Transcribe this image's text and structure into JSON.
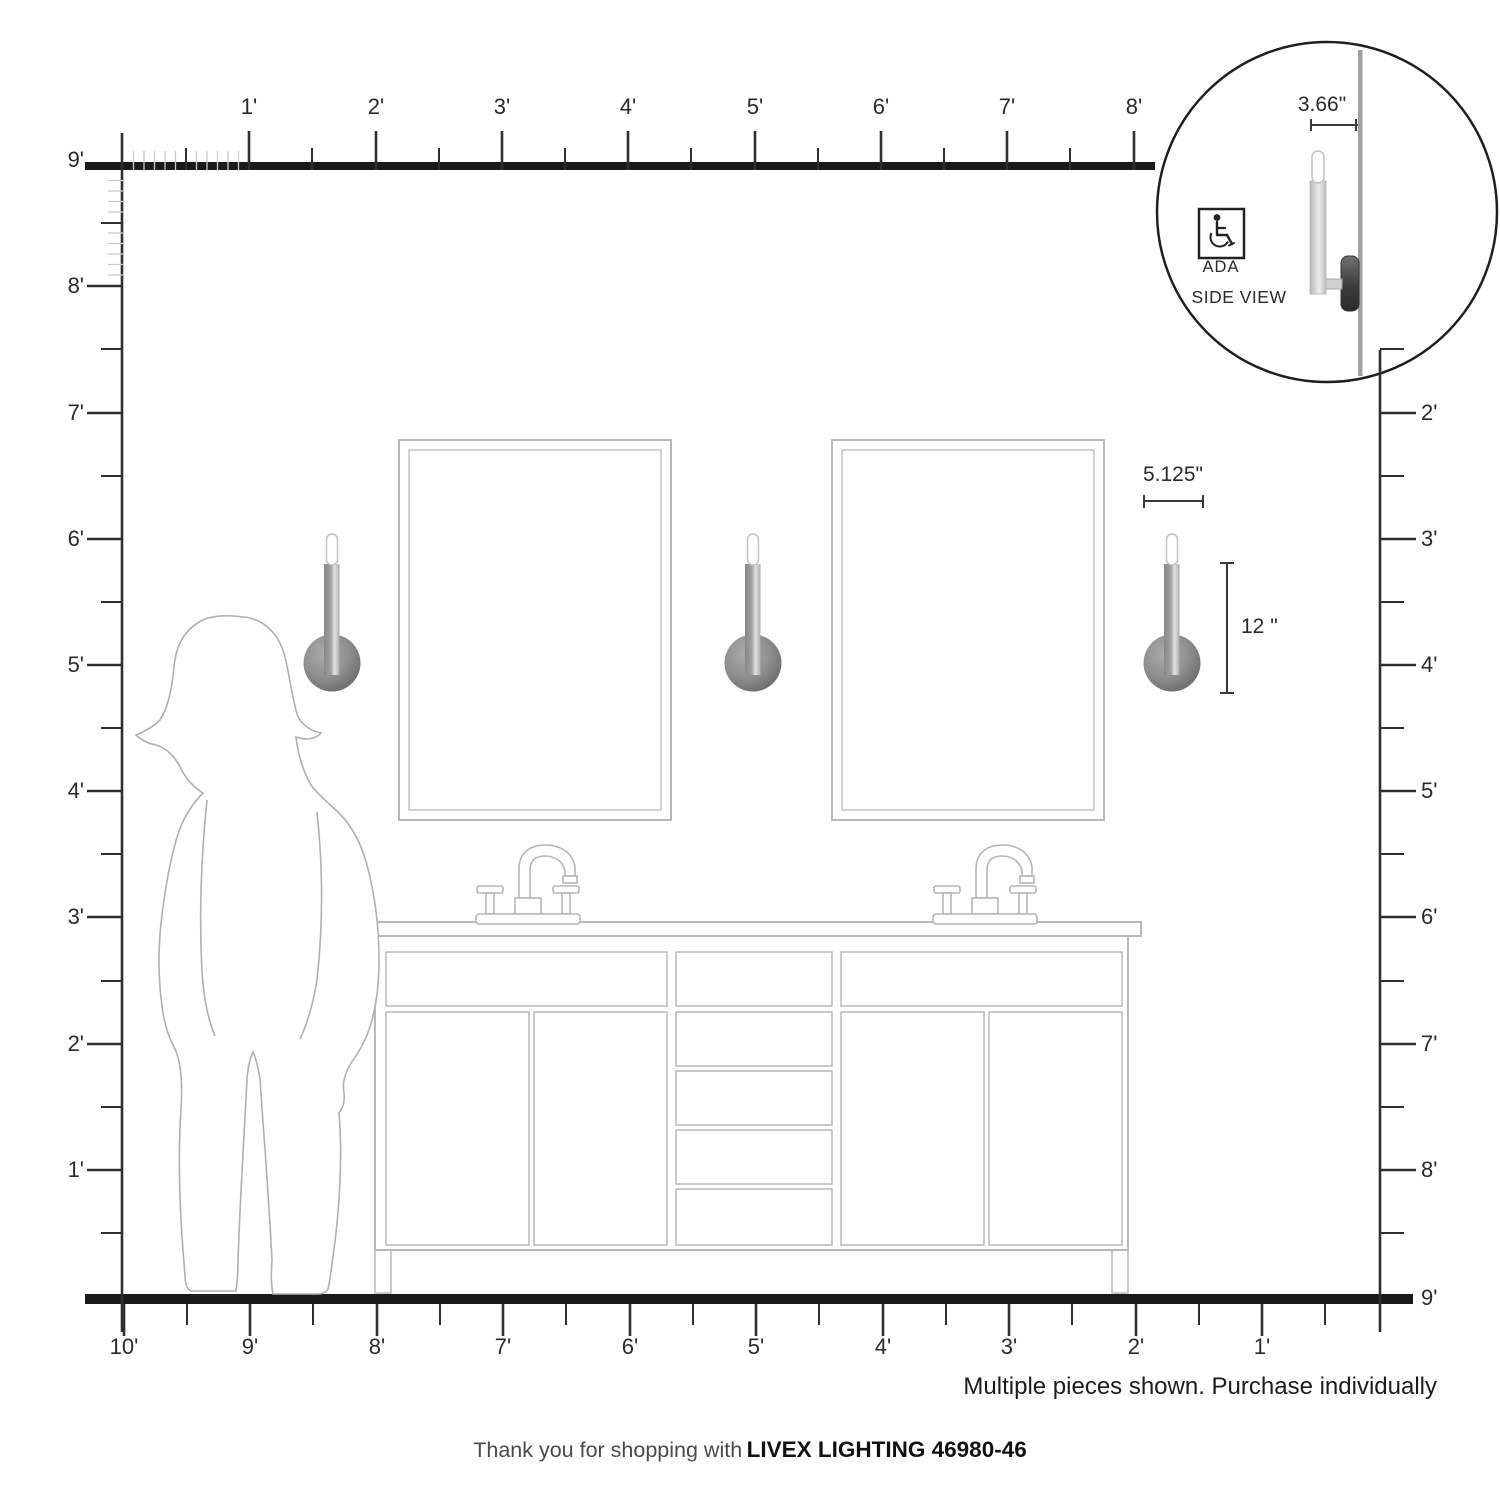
{
  "rulers": {
    "top": [
      "1'",
      "2'",
      "3'",
      "4'",
      "5'",
      "6'",
      "7'",
      "8'"
    ],
    "left": [
      "9'",
      "8'",
      "7'",
      "6'",
      "5'",
      "4'",
      "3'",
      "2'",
      "1'"
    ],
    "right": [
      "2'",
      "3'",
      "4'",
      "5'",
      "6'",
      "7'",
      "8'",
      "9'"
    ],
    "bottom": [
      "10'",
      "9'",
      "8'",
      "7'",
      "6'",
      "5'",
      "4'",
      "3'",
      "2'",
      "1'"
    ]
  },
  "dimensions": {
    "fixture_width": "5.125\"",
    "fixture_height": "12 \"",
    "fixture_depth": "3.66\""
  },
  "inset": {
    "ada_label": "ADA",
    "view_label": "SIDE VIEW"
  },
  "note": "Multiple pieces shown. Purchase individually",
  "footer": {
    "prefix": "Thank you for shopping with",
    "brand_model": "LIVEX LIGHTING 46980-46"
  }
}
